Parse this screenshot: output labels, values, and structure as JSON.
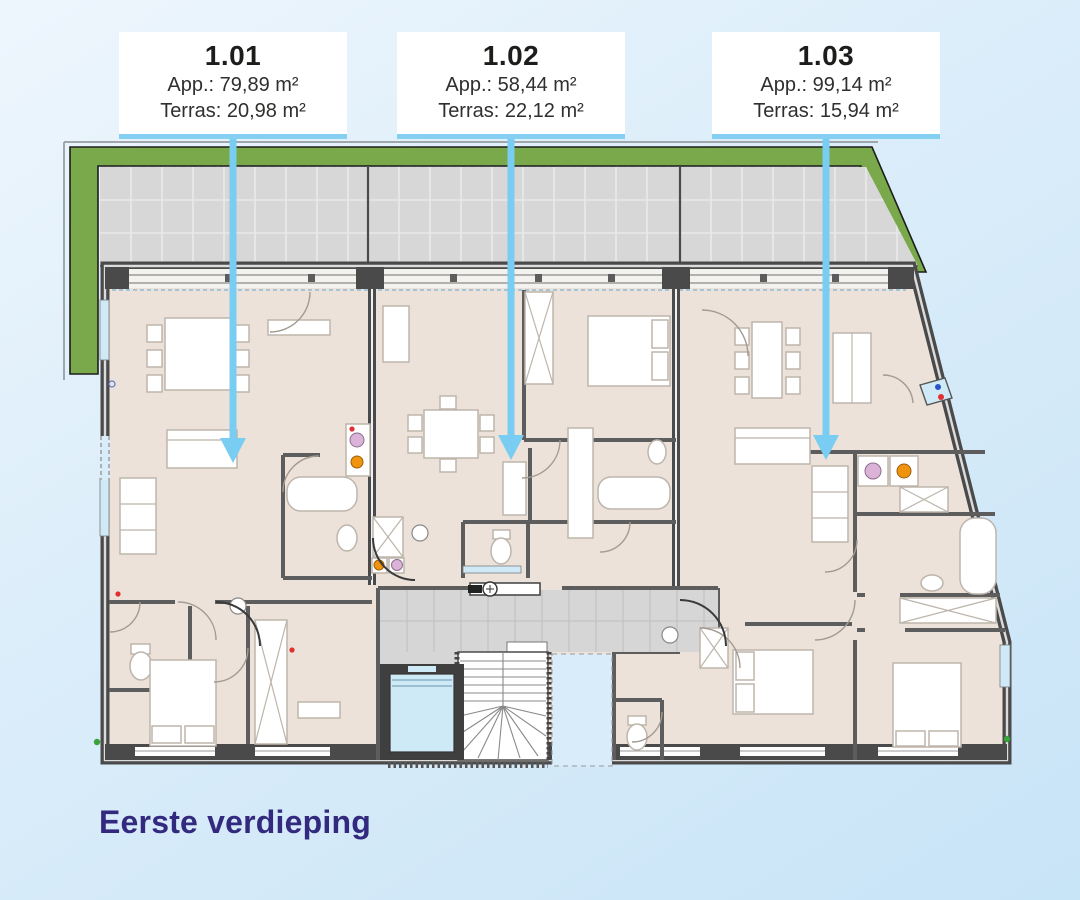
{
  "colors": {
    "background_top": "#eef6fd",
    "background_bottom": "#c8e4f7",
    "arrow": "#79cdf2",
    "card_border": "#85d0f2",
    "card_text": "#1d1d1b",
    "title": "#33297e",
    "green_roof": "#79a94a",
    "terrace_tile": "#d7d7d7",
    "floor": "#ece2d9",
    "wall": "#4a4a4a",
    "elevator": "#cdeaf6",
    "window": "#cfe9f7"
  },
  "floor_title": "Eerste verdieping",
  "apartments": [
    {
      "number": "1.01",
      "app_area": "App.: 79,89 m²",
      "terrace_area": "Terras: 20,98 m²"
    },
    {
      "number": "1.02",
      "app_area": "App.: 58,44 m²",
      "terrace_area": "Terras: 22,12 m²"
    },
    {
      "number": "1.03",
      "app_area": "App.: 99,14 m²",
      "terrace_area": "Terras: 15,94 m²"
    }
  ],
  "plan": {
    "areas": [
      "terrace",
      "green-roof-edge",
      "apartment-1.01",
      "apartment-1.02",
      "apartment-1.03",
      "stairwell",
      "elevator",
      "central-hall"
    ]
  }
}
